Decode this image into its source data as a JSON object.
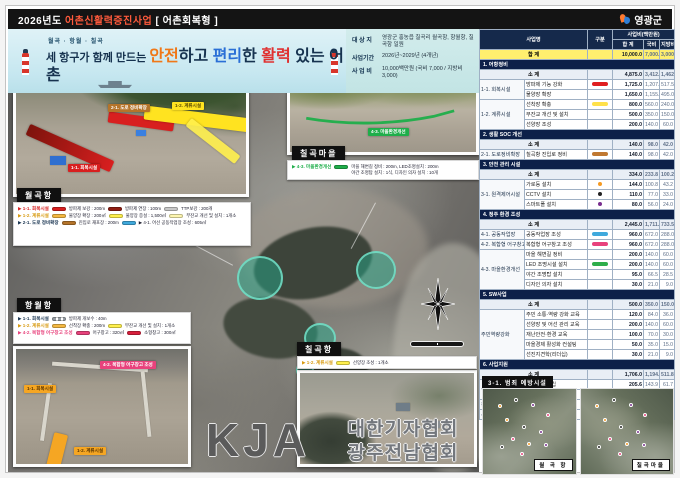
{
  "header": {
    "title_parts": [
      {
        "t": "2026년도 ",
        "c": "#ffffff"
      },
      {
        "t": "어촌신활력증진사업",
        "c": "#ff5a3c"
      },
      {
        "t": " [ 어촌회복형 ]",
        "c": "#ffffff"
      }
    ],
    "logo_text": "영광군"
  },
  "slogan": {
    "small": "월곡 · 항월 · 칠곡",
    "parts": [
      {
        "t": "세 항구가 함께 만드는 ",
        "c": "#16324f",
        "big": false
      },
      {
        "t": "안전",
        "c": "#f07818",
        "big": true
      },
      {
        "t": "하고 ",
        "c": "#16324f",
        "big": true
      },
      {
        "t": "편리",
        "c": "#2a6fd6",
        "big": true
      },
      {
        "t": "한 ",
        "c": "#16324f",
        "big": true
      },
      {
        "t": "활력",
        "c": "#e03030",
        "big": true
      },
      {
        "t": " 있는 어촌",
        "c": "#16324f",
        "big": true
      }
    ]
  },
  "info": {
    "rows": [
      {
        "label": "대 상 지",
        "value": "영광군 홍농읍 칠곡리 월곡항, 항월항, 칠곡항 일원"
      },
      {
        "label": "사업기간",
        "value": "2026년~2029년 (4개년)"
      },
      {
        "label": "사 업 비",
        "value": "10,000백만원 (국비 7,000 / 지방비 3,000)"
      }
    ]
  },
  "table": {
    "header": {
      "name": "사업명",
      "type": "구분",
      "amount": "사업비(백만원)",
      "cols": [
        "합 계",
        "국비",
        "지방비"
      ]
    },
    "total": {
      "label": "합 계",
      "v": [
        "10,000.0",
        "7,000.0",
        "3,000.0"
      ]
    },
    "subtotal_label": "소 계",
    "sections": [
      {
        "title": "1. 어항정비",
        "subtotal": [
          "4,875.0",
          "3,412.5",
          "1,462.5"
        ],
        "rows": [
          {
            "cat": "1-1. 회복시설",
            "rowspan": 2,
            "item": "방파제 기능 강화",
            "mark": {
              "kind": "bar",
              "color": "#e01f1f"
            },
            "v": [
              "1,725.0",
              "1,207.5",
              "517.5"
            ]
          },
          {
            "item": "물양장 확장",
            "v": [
              "1,650.0",
              "1,155.0",
              "495.0"
            ]
          },
          {
            "cat": "1-2. 계류시설",
            "rowspan": 3,
            "item": "선착장 확충",
            "mark": {
              "kind": "bar",
              "color": "#ffe14a"
            },
            "v": [
              "800.0",
              "560.0",
              "240.0"
            ]
          },
          {
            "item": "부잔교 개선 및 설치",
            "v": [
              "500.0",
              "350.0",
              "150.0"
            ]
          },
          {
            "item": "선양장 조성",
            "v": [
              "200.0",
              "140.0",
              "60.0"
            ]
          }
        ]
      },
      {
        "title": "2. 생활 SOC 개선",
        "subtotal": [
          "140.0",
          "98.0",
          "42.0"
        ],
        "rows": [
          {
            "cat": "2-1. 도로정비확장",
            "rowspan": 1,
            "item": "칠곡항 진입로 정비",
            "mark": {
              "kind": "bar",
              "color": "#c07830"
            },
            "v": [
              "140.0",
              "98.0",
              "42.0"
            ]
          }
        ]
      },
      {
        "title": "3. 안전 관리 시설",
        "subtotal": [
          "334.0",
          "233.8",
          "100.2"
        ],
        "rows": [
          {
            "cat": "3-1. 원격제어시설",
            "rowspan": 3,
            "item": "가로등 설치",
            "mark": {
              "kind": "dot",
              "color": "#f59a23"
            },
            "v": [
              "144.0",
              "100.8",
              "43.2"
            ]
          },
          {
            "item": "CCTV 설치",
            "mark": {
              "kind": "dot",
              "color": "#222222"
            },
            "v": [
              "110.0",
              "77.0",
              "33.0"
            ]
          },
          {
            "item": "스마트폴 설치",
            "mark": {
              "kind": "dot",
              "color": "#7a2f8f"
            },
            "v": [
              "80.0",
              "56.0",
              "24.0"
            ]
          }
        ]
      },
      {
        "title": "4. 정주 환경 조성",
        "subtotal": [
          "2,445.0",
          "1,711.5",
          "733.5"
        ],
        "rows": [
          {
            "cat": "4-1. 공동작업장",
            "rowspan": 1,
            "item": "공동작업장 조성",
            "mark": {
              "kind": "bar",
              "color": "#3fa9dc"
            },
            "v": [
              "960.0",
              "672.0",
              "288.0"
            ]
          },
          {
            "cat": "4-2. 복합형 어구창고",
            "rowspan": 1,
            "item": "복합형 어구창고 조성",
            "mark": {
              "kind": "bar",
              "color": "#e8427c"
            },
            "v": [
              "960.0",
              "672.0",
              "288.0"
            ]
          },
          {
            "cat": "4-3. 마을환경개선",
            "rowspan": 4,
            "item": "마을 해변길 정비",
            "v": [
              "200.0",
              "140.0",
              "60.0"
            ]
          },
          {
            "item": "LED 조명시설 설치",
            "mark": {
              "kind": "bar",
              "color": "#2fae4a"
            },
            "v": [
              "200.0",
              "140.0",
              "60.0"
            ]
          },
          {
            "item": "야간 조명탑 설치",
            "v": [
              "95.0",
              "66.5",
              "28.5"
            ]
          },
          {
            "item": "디자인 의자 설치",
            "v": [
              "30.0",
              "21.0",
              "9.0"
            ]
          }
        ]
      },
      {
        "title": "5. SW사업",
        "subtotal": [
          "500.0",
          "350.0",
          "150.0"
        ],
        "rows": [
          {
            "cat": "주민역량강화",
            "rowspan": 5,
            "item": "주민 소통·역량 강화 교육",
            "v": [
              "120.0",
              "84.0",
              "36.0"
            ]
          },
          {
            "item": "선양장 및 어선 관리 교육",
            "v": [
              "200.0",
              "140.0",
              "60.0"
            ]
          },
          {
            "item": "재난안전·환경 교육",
            "v": [
              "100.0",
              "70.0",
              "30.0"
            ]
          },
          {
            "item": "마을경제 활성화 컨설팅",
            "v": [
              "50.0",
              "35.0",
              "15.0"
            ]
          },
          {
            "item": "선진지견학(리더십)",
            "v": [
              "30.0",
              "21.0",
              "9.0"
            ]
          }
        ]
      },
      {
        "title": "6. 사업지원",
        "subtotal": [
          "1,706.0",
          "1,194.2",
          "511.8"
        ],
        "rows": [
          {
            "cat": "설계비",
            "rowspan": 2,
            "item": "기본계획 수립",
            "v": [
              "205.6",
              "143.9",
              "61.7"
            ]
          },
          {
            "item": "시행계획 수립",
            "v": [
              "390.5",
              "273.4",
              "117.1"
            ]
          },
          {
            "cat": "감리비",
            "rowspan": 1,
            "item": "공사감리비",
            "v": [
              "109.9",
              "76.9",
              "33.0"
            ]
          },
          {
            "cat": "사업관리비",
            "rowspan": 1,
            "item": "사업관리비",
            "v": [
              "1,000.0",
              "700.0",
              "300.0"
            ]
          }
        ]
      }
    ]
  },
  "insets": {
    "wolgok": {
      "title": "월곡항",
      "tags": [
        {
          "text": "1-1. 회복시설",
          "color": "#d81f1f"
        },
        {
          "text": "1-2. 계류시설",
          "color": "#ffe320"
        },
        {
          "text": "2-1. 도로 정비확장",
          "color": "#b5742a"
        }
      ],
      "legend": [
        {
          "label": "▶ 1-1. 회복시설",
          "label_color": "#d81f1f",
          "items": [
            {
              "sw": "#d81f1f",
              "text": "방파제 보강 : 200m"
            },
            {
              "sw": "#8f1d12",
              "text": "방파제 연장 : 100m"
            },
            {
              "sw": "#c9c9c9",
              "text": "TTP보강 : 200개"
            }
          ]
        },
        {
          "label": "▶ 1-2. 계류시설",
          "label_color": "#d89a10",
          "items": [
            {
              "sw": "#f5b942",
              "text": "물양장 확장 : 200㎡"
            },
            {
              "sw": "#fff04d",
              "text": "물양장 증설 : 1,500㎡"
            },
            {
              "sw": "#fdf6b0",
              "text": "부잔교 개선 및 설치 : 1개소"
            }
          ]
        },
        {
          "label": "▶ 2-1. 도로 정비확장",
          "label_color": "#16324f",
          "items": [
            {
              "sw": "#b5742a",
              "text": "진입로 재포장 : 200m"
            },
            {
              "sw": "#3fa9dc",
              "text": "▶ 4-1. 어선 공동작업장 조성 : 605㎡"
            }
          ]
        }
      ]
    },
    "chilgok_village": {
      "title": "칠곡마을",
      "tags": [
        {
          "text": "4-3. 마을환경개선",
          "color": "#1fae4a"
        }
      ],
      "legend": [
        {
          "label": "▶ 4-3. 마을환경개선",
          "label_color": "#1fae4a",
          "items": [
            {
              "sw": "#1fae4a",
              "text": "마을 해변길 정비 : 200m, LED조명설치 : 200m\n야간 조명탑 설치 : 1식, 디자인 의자 설치 : 10개"
            }
          ]
        }
      ]
    },
    "hangwol": {
      "title": "항월항",
      "tags": [
        {
          "text": "1-1. 회복시설",
          "color": "#f5a623"
        },
        {
          "text": "4-2. 복합형 어구창고 조성",
          "color": "#e8427c"
        },
        {
          "text": "1-2. 계류시설",
          "color": "#f5a623"
        }
      ],
      "legend": [
        {
          "label": "▶ 1-1. 회복시설",
          "label_color": "#16324f",
          "items": [
            {
              "sw": "dash",
              "text": "방파제 개보수 : 40m"
            }
          ]
        },
        {
          "label": "▶ 1-2. 계류시설",
          "label_color": "#d89a10",
          "items": [
            {
              "sw": "#f5b942",
              "text": "선착장 확충 : 200m"
            },
            {
              "sw": "#fff04d",
              "text": "부잔교 개선 및 설치 : 1개소"
            }
          ]
        },
        {
          "label": "▶ 4-2. 복합형 어구창고 조성",
          "label_color": "#e8427c",
          "items": [
            {
              "sw": "#e8427c",
              "text": "어구창고 : 320㎡"
            },
            {
              "sw": "#d81f3c",
              "text": "소형창고 : 300㎡"
            }
          ]
        }
      ]
    },
    "chilgok_port": {
      "title": "칠곡항",
      "legend": [
        {
          "label": "▶ 1-2. 계류시설",
          "label_color": "#d89a10",
          "items": [
            {
              "sw": "#fff04d",
              "text": "선양장 조성 : 1개소"
            }
          ]
        }
      ]
    }
  },
  "map": {
    "watermark_big": "KJA",
    "watermark_lines": "대한기자협회\n광주전남협회"
  },
  "bottom_right": {
    "tag": "3-1. 범죄 예방시설",
    "photos": [
      {
        "label": "월 곡 항"
      },
      {
        "label": "칠곡마을"
      }
    ],
    "dot_colors": [
      "#f59a23",
      "#222222",
      "#7a2f8f",
      "#e8427c"
    ]
  },
  "colors": {
    "accent_navy": "#0d2049",
    "header_navy": "#15294b",
    "total_yellow": "#ffef6e",
    "band_blue": "#c6e7f0",
    "focus_teal": "#26a88a"
  }
}
